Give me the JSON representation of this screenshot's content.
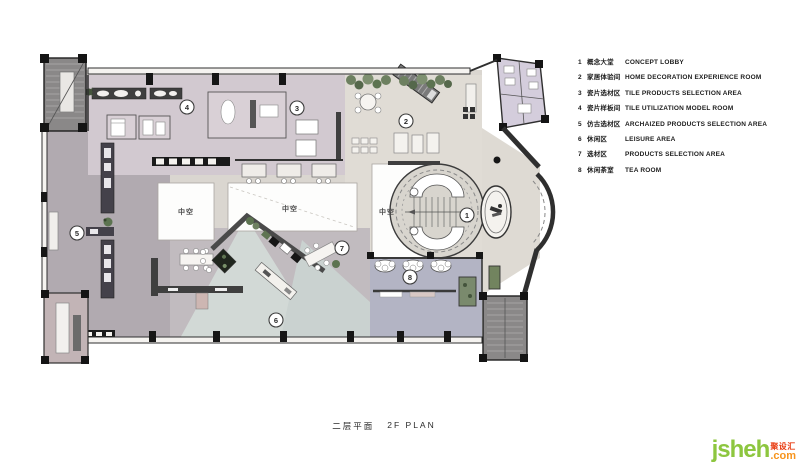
{
  "title": {
    "zh": "二层平面",
    "en": "2F PLAN"
  },
  "legend": {
    "items": [
      {
        "num": "1",
        "zh": "概念大堂",
        "en": "CONCEPT LOBBY"
      },
      {
        "num": "2",
        "zh": "家居体验间",
        "en": "HOME DECORATION EXPERIENCE ROOM"
      },
      {
        "num": "3",
        "zh": "瓷片选材区",
        "en": "TILE PRODUCTS SELECTION AREA"
      },
      {
        "num": "4",
        "zh": "瓷片样板间",
        "en": "TILE UTILIZATION MODEL ROOM"
      },
      {
        "num": "5",
        "zh": "仿古选材区",
        "en": "ARCHAIZED PRODUCTS SELECTION AREA"
      },
      {
        "num": "6",
        "zh": "休闲区",
        "en": "LEISURE AREA"
      },
      {
        "num": "7",
        "zh": "选材区",
        "en": "PRODUCTS SELECTION AREA"
      },
      {
        "num": "8",
        "zh": "休闲茶室",
        "en": "TEA ROOM"
      }
    ]
  },
  "plan": {
    "void_label": "中空",
    "markers": [
      "1",
      "2",
      "3",
      "4",
      "5",
      "6",
      "7",
      "8"
    ]
  },
  "watermark": {
    "name": "jsheh",
    "tld": ".com",
    "zh": "聚设汇"
  },
  "colors": {
    "base_floor": "#dad6d0",
    "left_zone": "#b1aab0",
    "rooms_zone": "#d2c9d0",
    "experience_zone": "#e0dcd5",
    "leisure_zone": "#c1bbbf",
    "fan_light": "#d2d9d6",
    "tea_zone": "#b3b4c4",
    "restroom_zone": "#d4cddc",
    "wall": "#2f2f2f",
    "plant_green": "#5c7350",
    "watermark_green": "#8dc63f",
    "watermark_orange": "#f7941d",
    "watermark_red": "#e8380d"
  }
}
